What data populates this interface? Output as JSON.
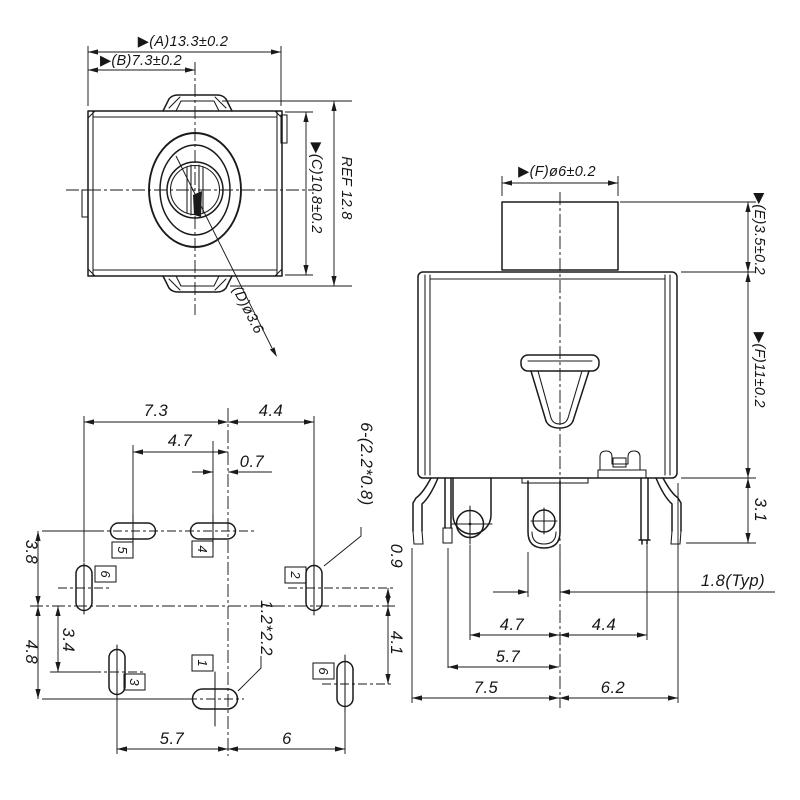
{
  "drawing": {
    "front": {
      "dim_a": "▶(A)13.3±0.2",
      "dim_b": "▶(B)7.3±0.2",
      "dim_c": "▶(C)10.8±0.2",
      "dim_ref": "REF 12.8",
      "dim_d": "(D)ø3.6"
    },
    "side": {
      "dim_f_dia": "▶(F)ø6±0.2",
      "dim_e": "▶(E)3.5±0.2",
      "dim_f_h": "▶(F)11±0.2",
      "dim_3_1": "3.1",
      "dim_1_8_typ": "1.8(Typ)",
      "dim_4_7": "4.7",
      "dim_4_4": "4.4",
      "dim_5_7": "5.7",
      "dim_7_5": "7.5",
      "dim_6_2": "6.2"
    },
    "footprint": {
      "dim_7_3": "7.3",
      "dim_4_4": "4.4",
      "dim_4_7": "4.7",
      "dim_0_7": "0.7",
      "slot_note": "6-(2.2*0.8)",
      "dim_0_9": "0.9",
      "dim_4_1": "4.1",
      "dim_3_8": "3.8",
      "dim_4_8": "4.8",
      "dim_3_4": "3.4",
      "pad_note": "1.2*2.2",
      "dim_5_7": "5.7",
      "dim_6": "6",
      "pins": [
        {
          "n": "5"
        },
        {
          "n": "4"
        },
        {
          "n": "6"
        },
        {
          "n": "2"
        },
        {
          "n": "3"
        },
        {
          "n": "1"
        },
        {
          "n": "6"
        }
      ]
    }
  }
}
